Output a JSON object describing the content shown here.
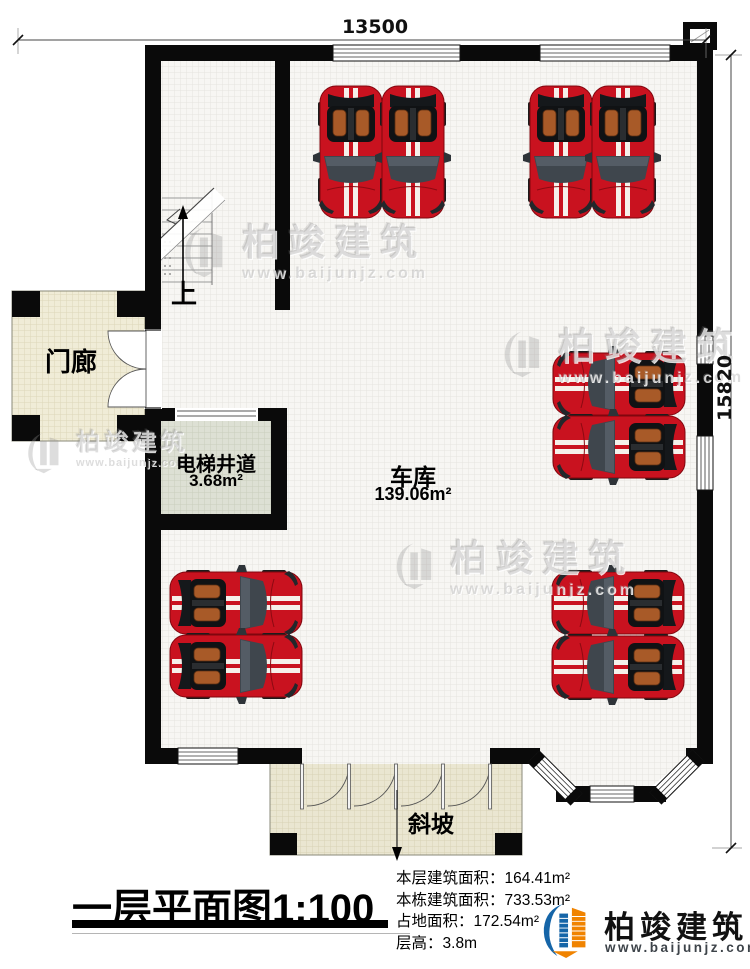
{
  "dimensions": {
    "width_mm": "13500",
    "height_mm": "15820"
  },
  "rooms": {
    "porch": {
      "name": "门廊"
    },
    "elevator_shaft": {
      "name": "电梯井道",
      "area": "3.68m²"
    },
    "garage": {
      "name": "车库",
      "area": "139.06m²"
    },
    "stairs": {
      "direction_label": "上"
    },
    "ramp": {
      "name": "斜坡"
    }
  },
  "footer": {
    "title": "一层平面图1:100",
    "stats": [
      {
        "label": "本层建筑面积：",
        "value": "164.41m²"
      },
      {
        "label": "本栋建筑面积：",
        "value": "733.53m²"
      },
      {
        "label": "占地面积：",
        "value": "172.54m²"
      },
      {
        "label": "层高：",
        "value": "3.8m"
      }
    ],
    "brand": {
      "name": "柏竣建筑",
      "url": "www.baijunjz.com"
    }
  },
  "watermark": {
    "name": "柏竣建筑",
    "url": "www.baijunjz.com"
  },
  "colors": {
    "wall": "#0a0a0a",
    "car": "#c9121f",
    "porch_floor": "#f0ecd7",
    "elevator_floor": "#dde0d4",
    "ramp_floor": "#eae6d1",
    "brand_blue": "#1565a8",
    "brand_orange": "#f08300"
  }
}
